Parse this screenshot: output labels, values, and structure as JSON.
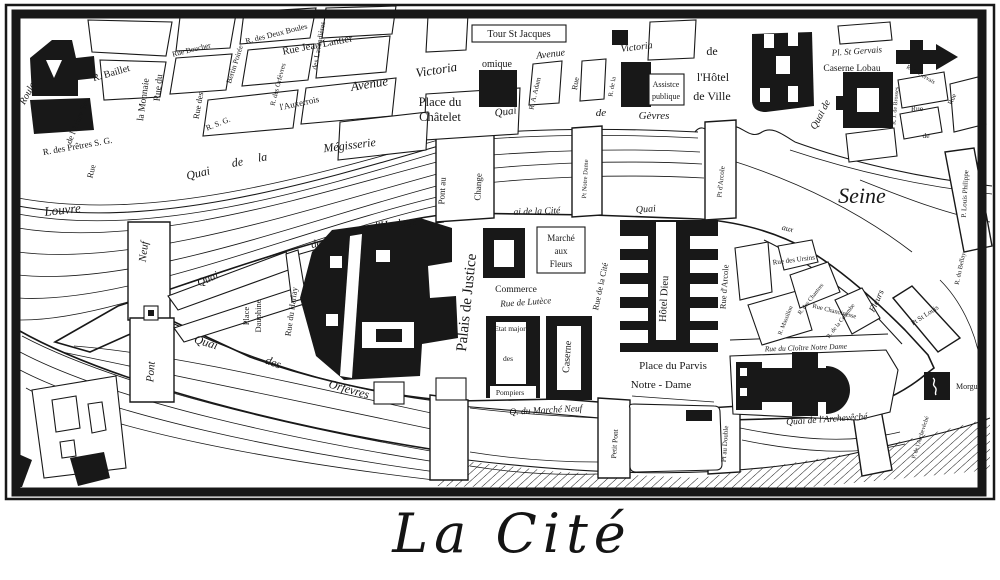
{
  "title": "La Cité",
  "colors": {
    "ink": "#181818",
    "paper": "#ffffff"
  },
  "map": {
    "river_name": "Seine",
    "labels": {
      "roule": "Roule",
      "r_baillet": "R. Baillet",
      "arbre_sec": "de l'Arbre Sec",
      "rue_a": "Rue",
      "la_monnaie": "la Monnaie",
      "rue_du": "Rue du",
      "pretres": "R. des Prêtres S. G.",
      "rue_boucher": "Rue Boucher",
      "rue_des": "Rue des",
      "rsg": "R. S. G.",
      "auxerrois": "l'Auxerrois",
      "deux_boules": "R. des Deux Boules",
      "jean_lantier": "Rue Jean Lantier",
      "lavandieres": "des Lavandières",
      "bertin_poiree": "Bertin Poirée",
      "orfevres_rue": "R. des Orfèvres",
      "avenue_w": "Avenue",
      "victoria_w": "Victoria",
      "avenue_e": "Avenue",
      "victoria_e": "Victoria",
      "place_chatelet": [
        "Place du",
        "Châtelet"
      ],
      "tour_st_jacques": "Tour St Jacques",
      "omique": "omique",
      "quai_gevres": [
        "Quai",
        "de",
        "Gèvres"
      ],
      "adam": "R. A. Adam",
      "rue_b": "Rue",
      "r_de_la": "R. de la",
      "assistance": [
        "Assistce",
        "publique"
      ],
      "hotel_de_ville": [
        "de",
        "l'Hôtel",
        "de Ville"
      ],
      "pl_st_gervais": "Pl. St Gervais",
      "caserne_lobau": "Caserne Lobau",
      "quai_de_hv": "Quai de",
      "brosses": "R. J. de Brosses",
      "st_gervais_rue": "R. St Gervais",
      "rue_c": "Rue",
      "de_c": "de",
      "rue_d": "Rue",
      "seine": "Seine",
      "louvre": "Louvre",
      "megisserie": [
        "Quai",
        "de",
        "la",
        "Mégisserie"
      ],
      "pont_neuf": [
        "Neuf",
        "Pont"
      ],
      "horloge": [
        "Quai",
        "de",
        "l'Horloge"
      ],
      "place_dauphine": [
        "Place",
        "Dauphine"
      ],
      "harlay": "Rue du Harlay",
      "quai_orfevres": [
        "Quai",
        "des",
        "Orfèvres"
      ],
      "palais_justice": "Palais de Justice",
      "marche_fleurs": [
        "Marché",
        "aux",
        "Fleurs"
      ],
      "commerce": "Commerce",
      "lutece": "Rue de Lutèce",
      "etat_major": [
        "Etat major",
        "des",
        "Pompiers"
      ],
      "caserne": "Caserne",
      "q_marche_neuf": "Q. du Marché Neuf",
      "quai_cite": "ai de la Cité",
      "quai_hd": "Quai",
      "pont_change": [
        "Pont au",
        "Change"
      ],
      "pt_notre_dame": "Pt Notre Dame",
      "pt_arcole": "Pt d'Arcole",
      "rue_arcole": "Rue d'Arcole",
      "hotel_dieu": "Hôtel Dieu",
      "rue_cite": "Rue de la Cité",
      "parvis": [
        "Place du Parvis",
        "Notre - Dame"
      ],
      "cloitre": "Rue du Cloître Notre Dame",
      "ursins": "Rue des Ursins",
      "chantres": "R. des Chantres",
      "chanoinesse": "Rue Chanoinesse",
      "massillon": "R. Massillon",
      "colombe": "R. de la Colombe",
      "q_fleurs": [
        "aux",
        "Fleurs"
      ],
      "pt_st_louis": "Pt St Louis",
      "p_louis_philippe": "P. Louis Philippe",
      "r_bellay": "R. du Bellay",
      "morgue": "Morgue",
      "q_archeveche": "Quai de l'Archevêché",
      "pt_archeveche": "P. de l'Archevêché",
      "pt_double": "Pt au Double",
      "petit_pont": "Petit Pont"
    }
  }
}
